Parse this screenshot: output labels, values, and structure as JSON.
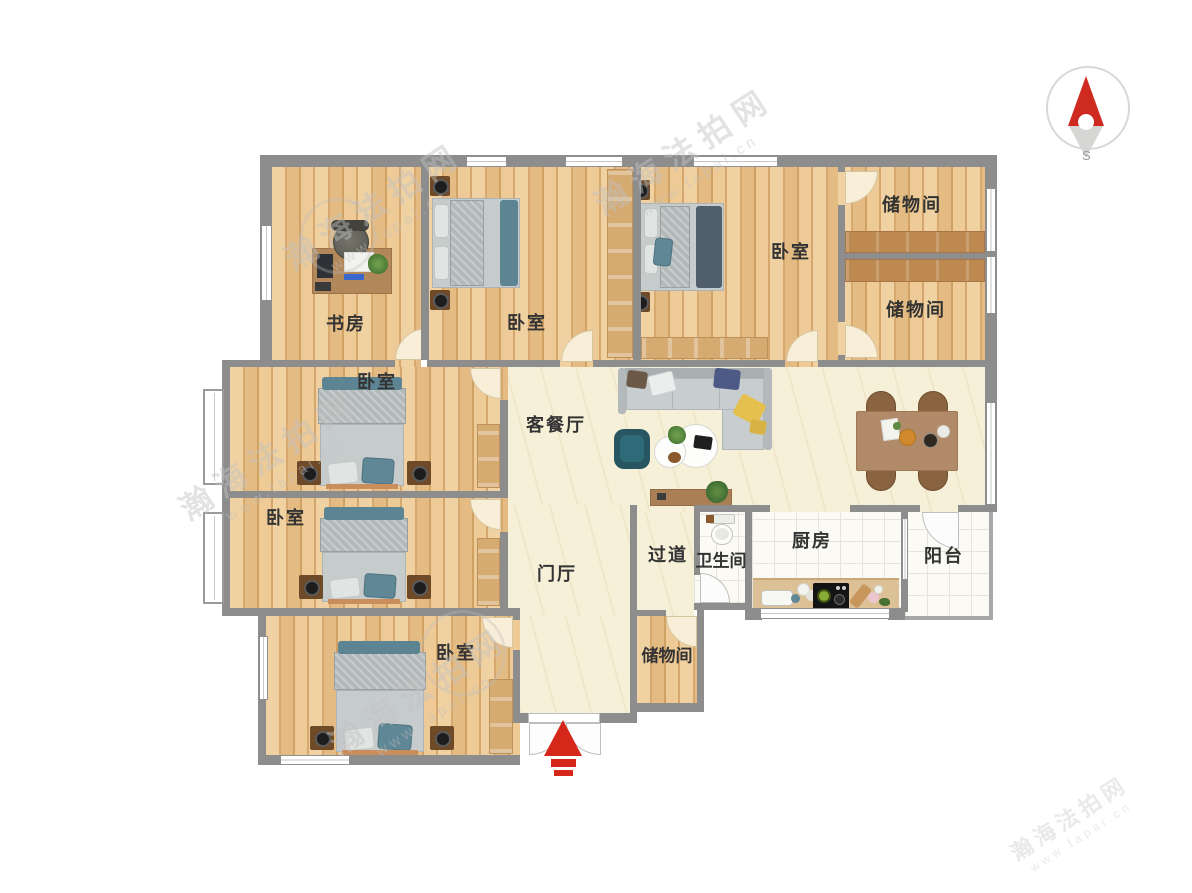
{
  "compass": {
    "south": "S"
  },
  "watermark": {
    "brand": "瀚海法拍网",
    "url": "www.fapai.cn"
  },
  "colors": {
    "wall": "#8d8d8d",
    "wood_floor": "#e9c28a",
    "cream_floor": "#f7f0d8",
    "tile_floor": "#fbfaf4",
    "accent_red": "#d5281b"
  },
  "rooms": {
    "study": {
      "label": "书房"
    },
    "bedroom_top_middle": {
      "label": "卧室"
    },
    "bedroom_top_right": {
      "label": "卧室"
    },
    "storage_right_top": {
      "label": "储物间"
    },
    "storage_right_bottom": {
      "label": "储物间"
    },
    "bedroom_left_top": {
      "label": "卧室"
    },
    "bedroom_left_middle": {
      "label": "卧室"
    },
    "bedroom_left_bottom": {
      "label": "卧室"
    },
    "living_dining": {
      "label": "客餐厅"
    },
    "entrance_hall": {
      "label": "门厅"
    },
    "corridor": {
      "label": "过道"
    },
    "bathroom": {
      "label": "卫生间"
    },
    "kitchen": {
      "label": "厨房"
    },
    "balcony": {
      "label": "阳台"
    },
    "storage_bottom": {
      "label": "储物间"
    }
  }
}
